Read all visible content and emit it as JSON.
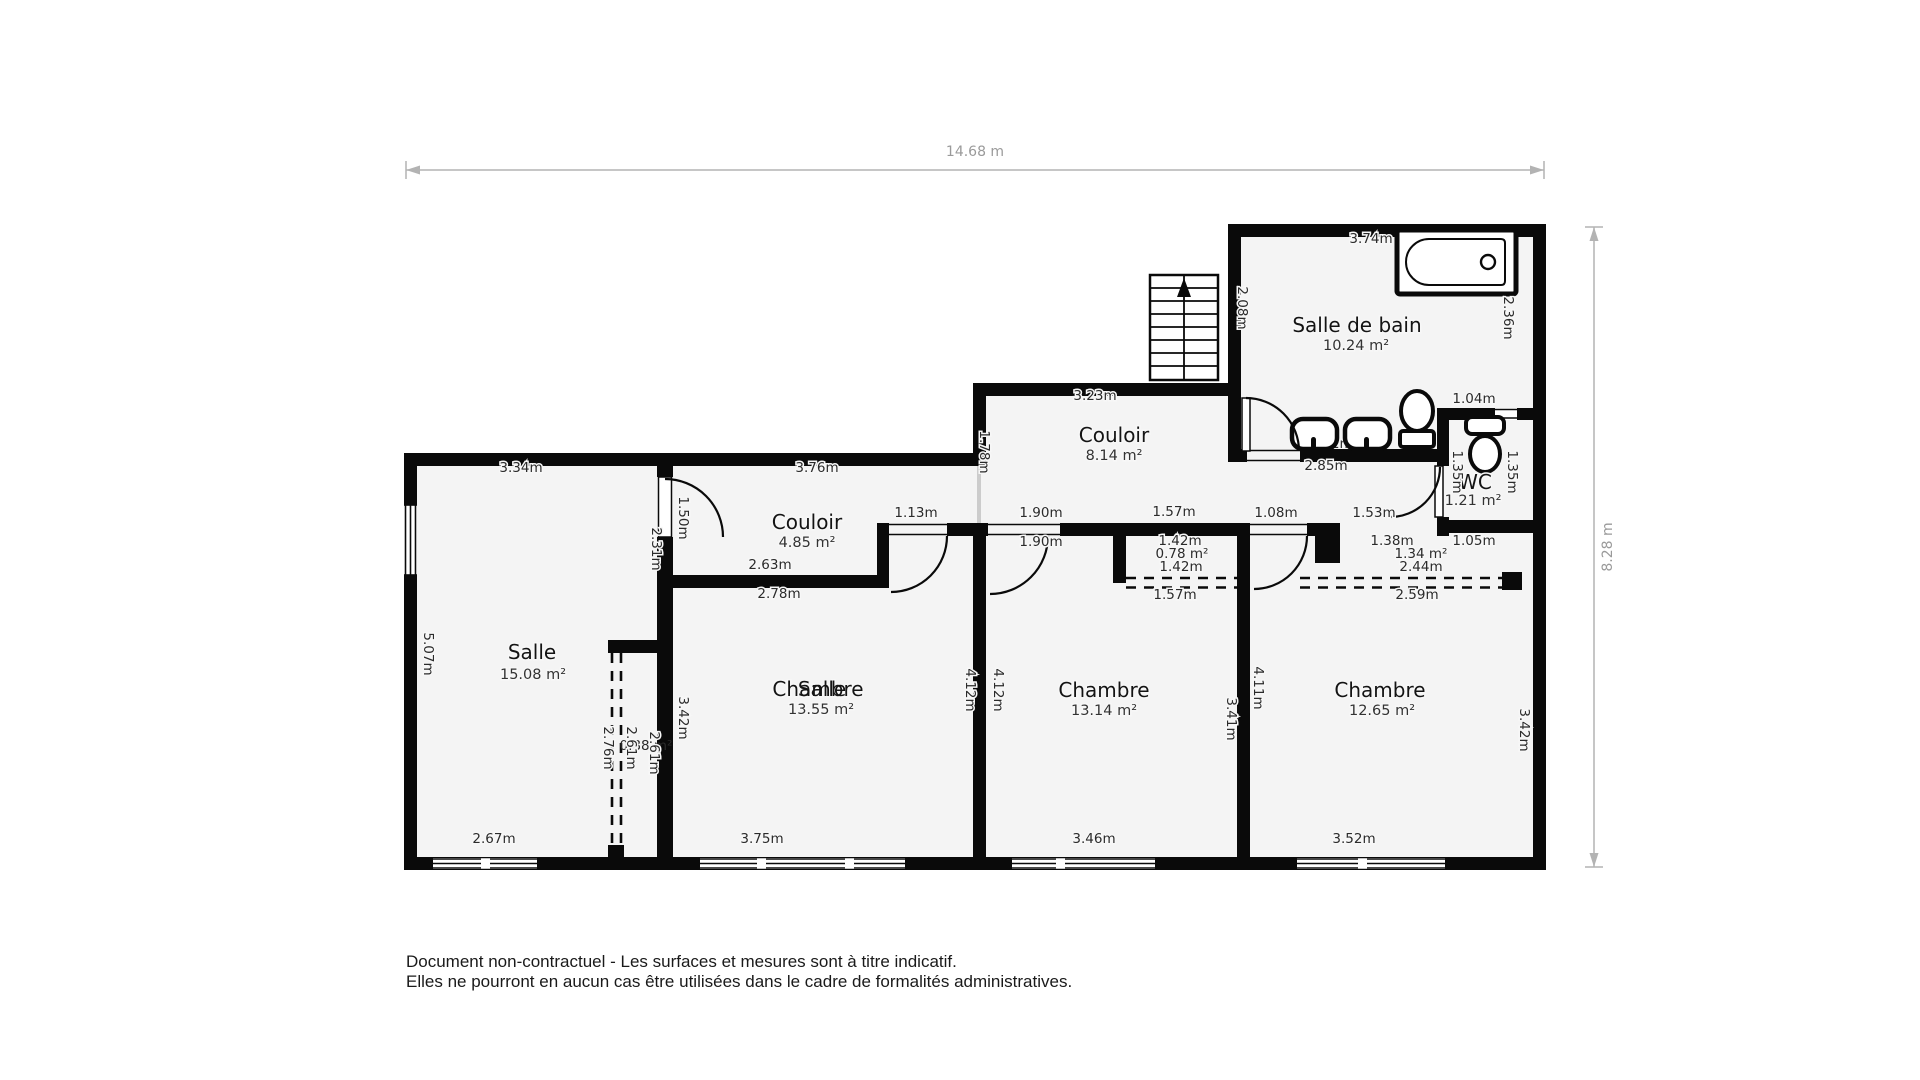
{
  "dims": {
    "top": "14.68 m",
    "right": "8.28 m"
  },
  "sdb": {
    "name": "Salle de bain",
    "area": "10.24 m²",
    "d374": "3.74m",
    "d236": "2.36m",
    "d208": "2.08m",
    "d271": "2.71m",
    "d285": "2.85m",
    "d104": "1.04m"
  },
  "wc": {
    "name": "WC",
    "area": "1.21 m²",
    "d135l": "1.35m",
    "d135r": "1.35m"
  },
  "col8": {
    "name": "Couloir",
    "area": "8.14 m²",
    "d323": "3.23m",
    "d178": "1.78m",
    "d190a": "1.90m",
    "d157": "1.57m",
    "d108": "1.08m",
    "d190b": "1.90m"
  },
  "col4": {
    "name": "Couloir",
    "area": "4.85 m²",
    "d376": "3.76m",
    "d113": "1.13m",
    "d150": "1.50m",
    "d231": "2.31m",
    "d263": "2.63m",
    "d278": "2.78m"
  },
  "salle": {
    "name": "Salle",
    "area": "15.08 m²",
    "d334": "3.34m",
    "d507": "5.07m",
    "d267": "2.67m"
  },
  "placard_salle": {
    "d276": "2.76m",
    "d261a": "2.61m",
    "d261b": "2.61m",
    "area": "0.88 m²",
    "d342": "3.42m"
  },
  "ch1": {
    "name": "Chambre",
    "overlay": "Salle",
    "area": "13.55 m²",
    "d412": "4.12m",
    "d375": "3.75m"
  },
  "ch2": {
    "name": "Chambre",
    "area": "13.14 m²",
    "d412": "4.12m",
    "d341": "3.41m",
    "c142a": "1.42m",
    "c078": "0.78 m²",
    "c142b": "1.42m",
    "c157": "1.57m",
    "d346": "3.46m"
  },
  "ch3": {
    "name": "Chambre",
    "area": "12.65 m²",
    "d411": "4.11m",
    "d342": "3.42m",
    "c138": "1.38m",
    "c105": "1.05m",
    "c134": "1.34 m²",
    "c244": "2.44m",
    "c259": "2.59m",
    "d153": "1.53m",
    "d352": "3.52m"
  },
  "footer": {
    "line1": "Document non-contractuel - Les surfaces et mesures sont à titre indicatif.",
    "line2": "Elles ne pourront en aucun cas être utilisées dans le cadre de formalités administratives."
  }
}
